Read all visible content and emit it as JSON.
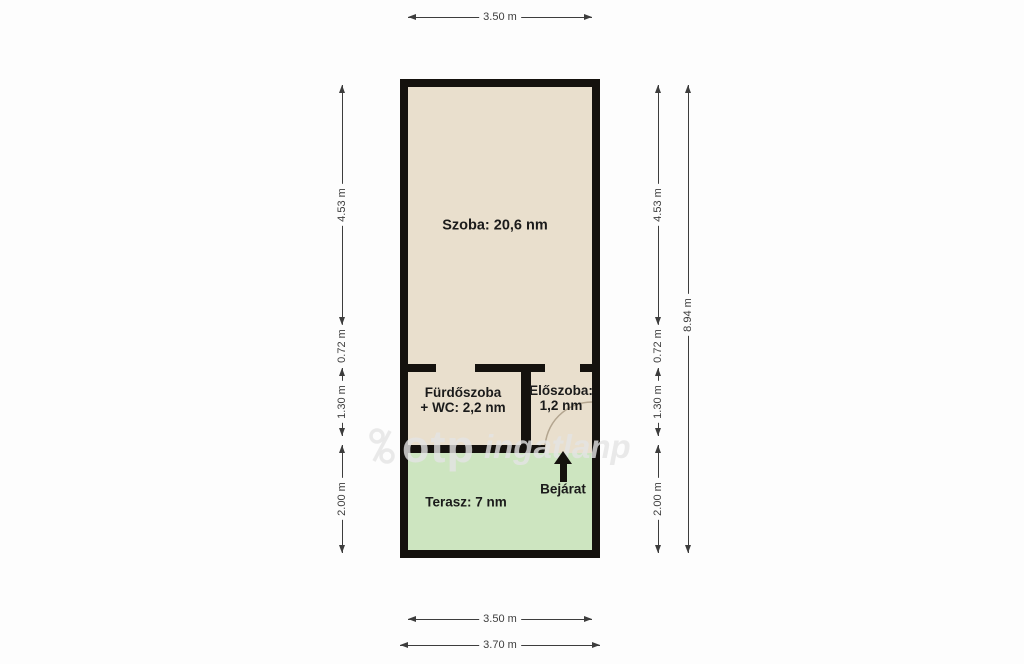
{
  "rooms": {
    "szoba": {
      "label": "Szoba: 20,6 nm"
    },
    "furdoszoba": {
      "line1": "Fürdőszoba",
      "line2": "+ WC: 2,2 nm"
    },
    "eloszoba": {
      "line1": "Előszoba:",
      "line2": "1,2 nm"
    },
    "terasz": {
      "label": "Terasz: 7 nm"
    },
    "bejarat": {
      "label": "Bejárat"
    }
  },
  "dimensions": {
    "top": "3.50 m",
    "bottom_inner": "3.50 m",
    "bottom_outer": "3.70 m",
    "left": [
      "4.53 m",
      "0.72 m",
      "1.30 m",
      "2.00 m"
    ],
    "right": [
      "4.53 m",
      "0.72 m",
      "1.30 m",
      "2.00 m"
    ],
    "right_total": "8.94 m"
  },
  "watermark": {
    "brand": "otp",
    "suffix": "ingatlanp"
  },
  "icons": {
    "entrance": "up-arrow-icon",
    "logo": "otp-logo-mark-icon"
  },
  "colors": {
    "bg": "#fdfdfd",
    "wall": "#15120e",
    "room_fill": "#e9dfcd",
    "terrace_fill": "#cde5c0",
    "dim": "#3d3d3d",
    "text": "#1b1b1b",
    "watermark": "rgba(228,228,228,0.8)",
    "arc": "#b3a58f"
  }
}
